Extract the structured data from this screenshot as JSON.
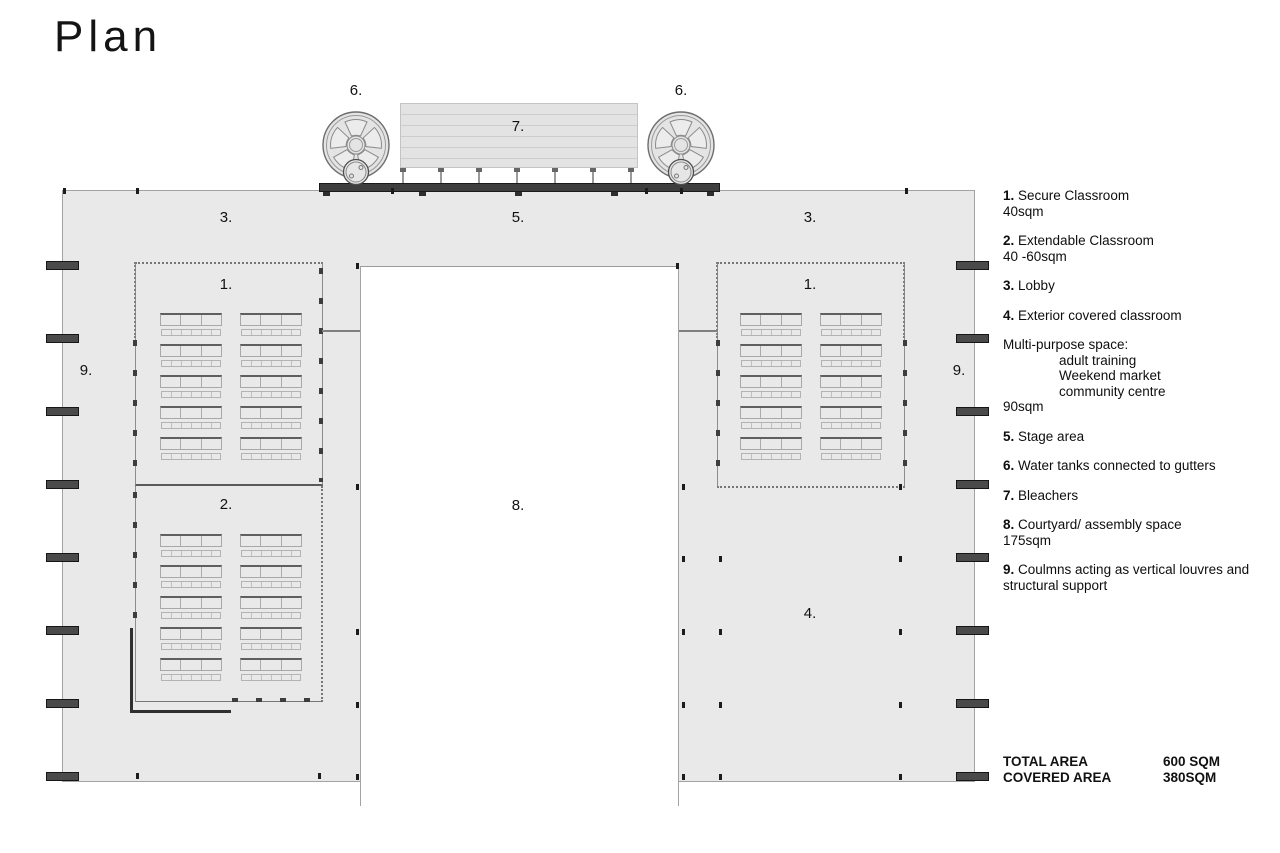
{
  "page": {
    "title": "Plan"
  },
  "plan": {
    "markers": {
      "m1": "1.",
      "m2": "2.",
      "m3": "3.",
      "m4": "4.",
      "m5": "5.",
      "m6": "6.",
      "m7": "7.",
      "m8": "8.",
      "m9": "9."
    }
  },
  "legend": {
    "items": [
      {
        "num": "1.",
        "label": "Secure Classroom",
        "detail": "40sqm"
      },
      {
        "num": "2.",
        "label": "Extendable Classroom",
        "detail": "40 -60sqm"
      },
      {
        "num": "3.",
        "label": "Lobby"
      },
      {
        "num": "4.",
        "label": "Exterior covered classroom"
      },
      {
        "num": "",
        "label": "Multi-purpose space:",
        "options": [
          "adult training",
          "Weekend market",
          "community centre"
        ],
        "detail": "90sqm"
      },
      {
        "num": "5.",
        "label": "Stage area"
      },
      {
        "num": "6.",
        "label": "Water tanks connected to gutters"
      },
      {
        "num": "7.",
        "label": "Bleachers"
      },
      {
        "num": "8.",
        "label": "Courtyard/ assembly space",
        "detail": "175sqm"
      },
      {
        "num": "9.",
        "label": "Coulmns acting as vertical louvres and structural support"
      }
    ]
  },
  "totals": {
    "rows": [
      {
        "label": "TOTAL AREA",
        "value": "600 SQM"
      },
      {
        "label": "COVERED AREA",
        "value": "380SQM"
      }
    ]
  },
  "colors": {
    "floor": "#e9e9e9",
    "line": "#8c8c8c",
    "dark_bar": "#3e3e3e",
    "column": "#4a4a4a"
  }
}
